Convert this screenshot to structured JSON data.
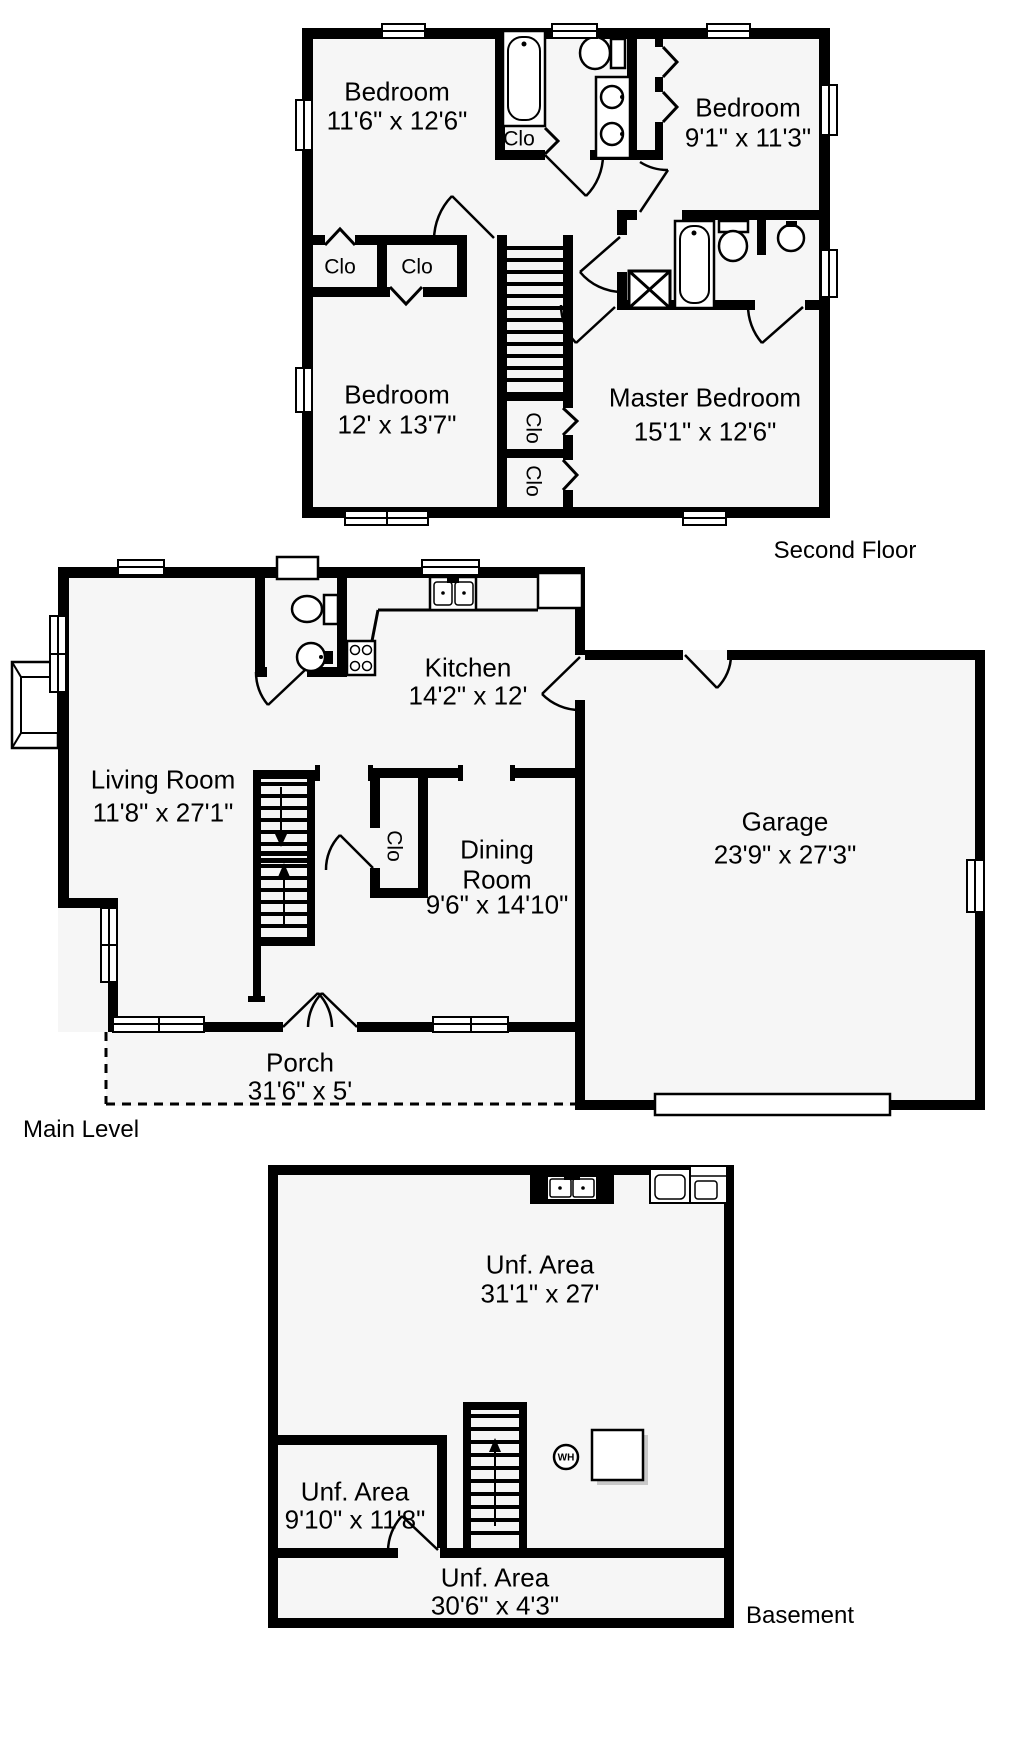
{
  "colors": {
    "wall": "#000000",
    "floor": "#f6f6f6",
    "background": "#ffffff"
  },
  "shared": {
    "closet_label": "Clo",
    "water_heater_label": "WH"
  },
  "floors": {
    "second_floor": {
      "title": "Second Floor",
      "rooms": {
        "bedroom_top_left": {
          "name": "Bedroom",
          "dims": "11'6\" x 12'6\""
        },
        "bedroom_top_right": {
          "name": "Bedroom",
          "dims": "9'1\" x 11'3\""
        },
        "bedroom_bottom_left": {
          "name": "Bedroom",
          "dims": "12' x 13'7\""
        },
        "master_bedroom": {
          "name": "Master Bedroom",
          "dims": "15'1\" x 12'6\""
        }
      }
    },
    "main_level": {
      "title": "Main Level",
      "rooms": {
        "living_room": {
          "name": "Living Room",
          "dims": "11'8\" x 27'1\""
        },
        "kitchen": {
          "name": "Kitchen",
          "dims": "14'2\" x 12'"
        },
        "dining_room": {
          "name": "Dining",
          "name2": "Room",
          "dims": "9'6\" x 14'10\""
        },
        "garage": {
          "name": "Garage",
          "dims": "23'9\" x 27'3\""
        },
        "porch": {
          "name": "Porch",
          "dims": "31'6\" x 5'"
        }
      }
    },
    "basement": {
      "title": "Basement",
      "rooms": {
        "unf_area_main": {
          "name": "Unf. Area",
          "dims": "31'1\" x 27'"
        },
        "unf_area_small": {
          "name": "Unf. Area",
          "dims": "9'10\" x 11'8\""
        },
        "unf_area_strip": {
          "name": "Unf. Area",
          "dims": "30'6\" x 4'3\""
        }
      }
    }
  }
}
